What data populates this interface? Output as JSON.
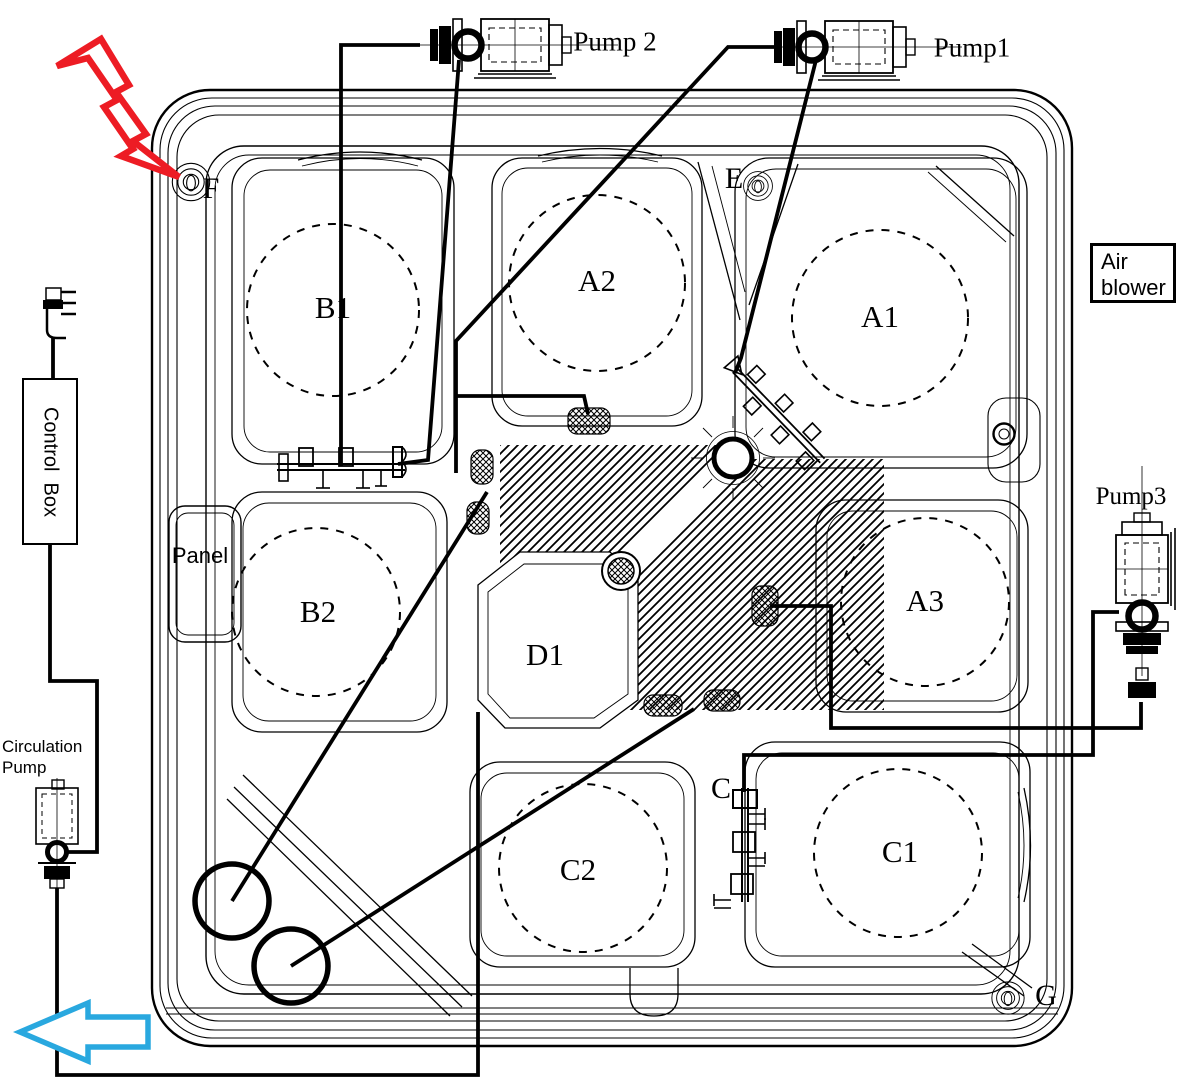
{
  "equipment": {
    "pump1": "Pump1",
    "pump2": "Pump 2",
    "pump3": "Pump3",
    "air_blower": "Air blower",
    "control_box": "Control  Box",
    "circulation_pump": "Circulation Pump",
    "panel": "Panel"
  },
  "seats": [
    {
      "label": "B1"
    },
    {
      "label": "A2"
    },
    {
      "label": "A1"
    },
    {
      "label": "B2"
    },
    {
      "label": "D1"
    },
    {
      "label": "A3"
    },
    {
      "label": "C2"
    },
    {
      "label": "C1"
    }
  ],
  "markers": [
    {
      "label": "F"
    },
    {
      "label": "E"
    },
    {
      "label": "C"
    },
    {
      "label": "G"
    }
  ],
  "colors": {
    "line": "#000000",
    "lightning_red": "#ed1c24",
    "arrow_blue": "#29a8df",
    "background": "#ffffff"
  }
}
